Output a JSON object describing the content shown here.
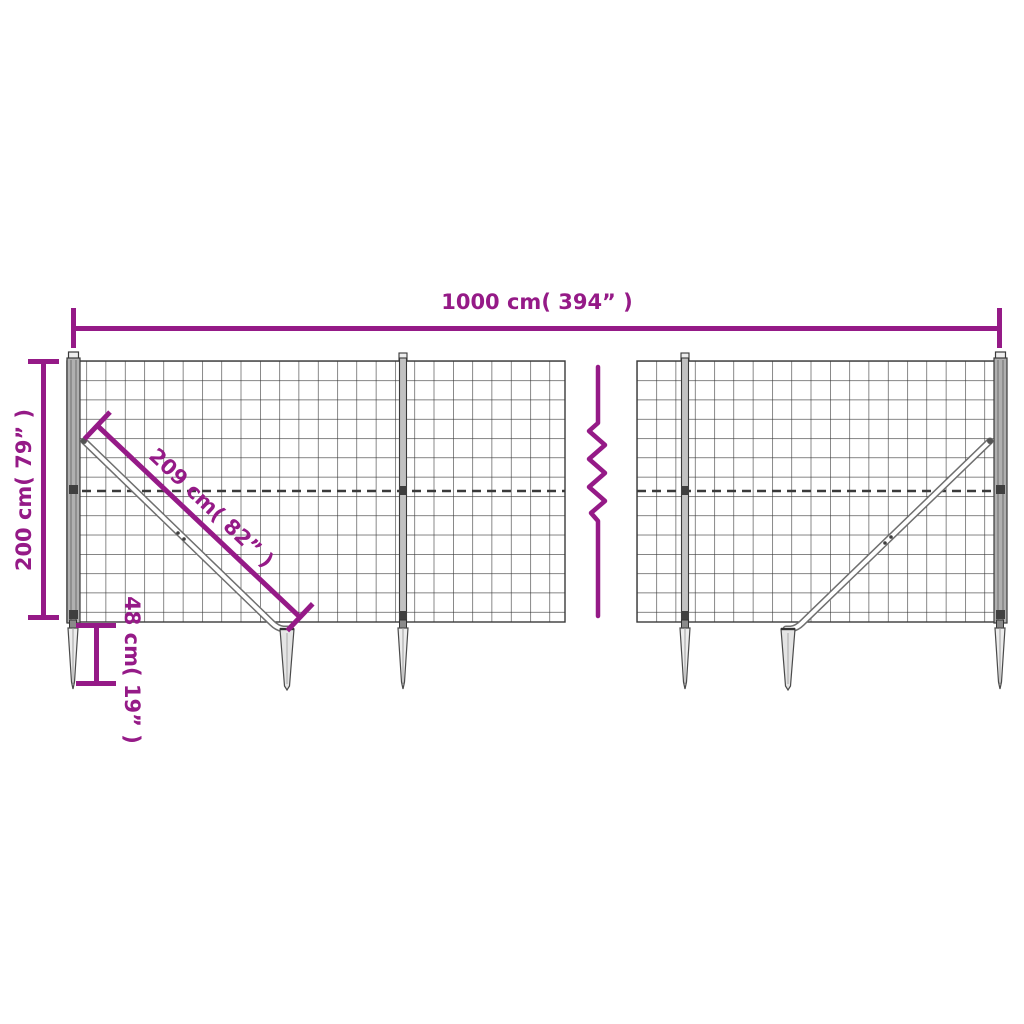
{
  "diagram": {
    "subject": "wire-mesh-fence-with-ground-anchor-spikes",
    "colors": {
      "dimension_accent": "#951a87",
      "wire": "#3a3a3a",
      "post_fill": "#b0b0b0",
      "spike_fill": "#ececec",
      "background": "#ffffff"
    },
    "dimensions": {
      "total_width_label": "1000 cm( 394” )",
      "height_label": "200 cm( 79” )",
      "brace_length_label": "209 cm( 82” )",
      "anchor_depth_label": "48 cm( 19” )"
    }
  }
}
